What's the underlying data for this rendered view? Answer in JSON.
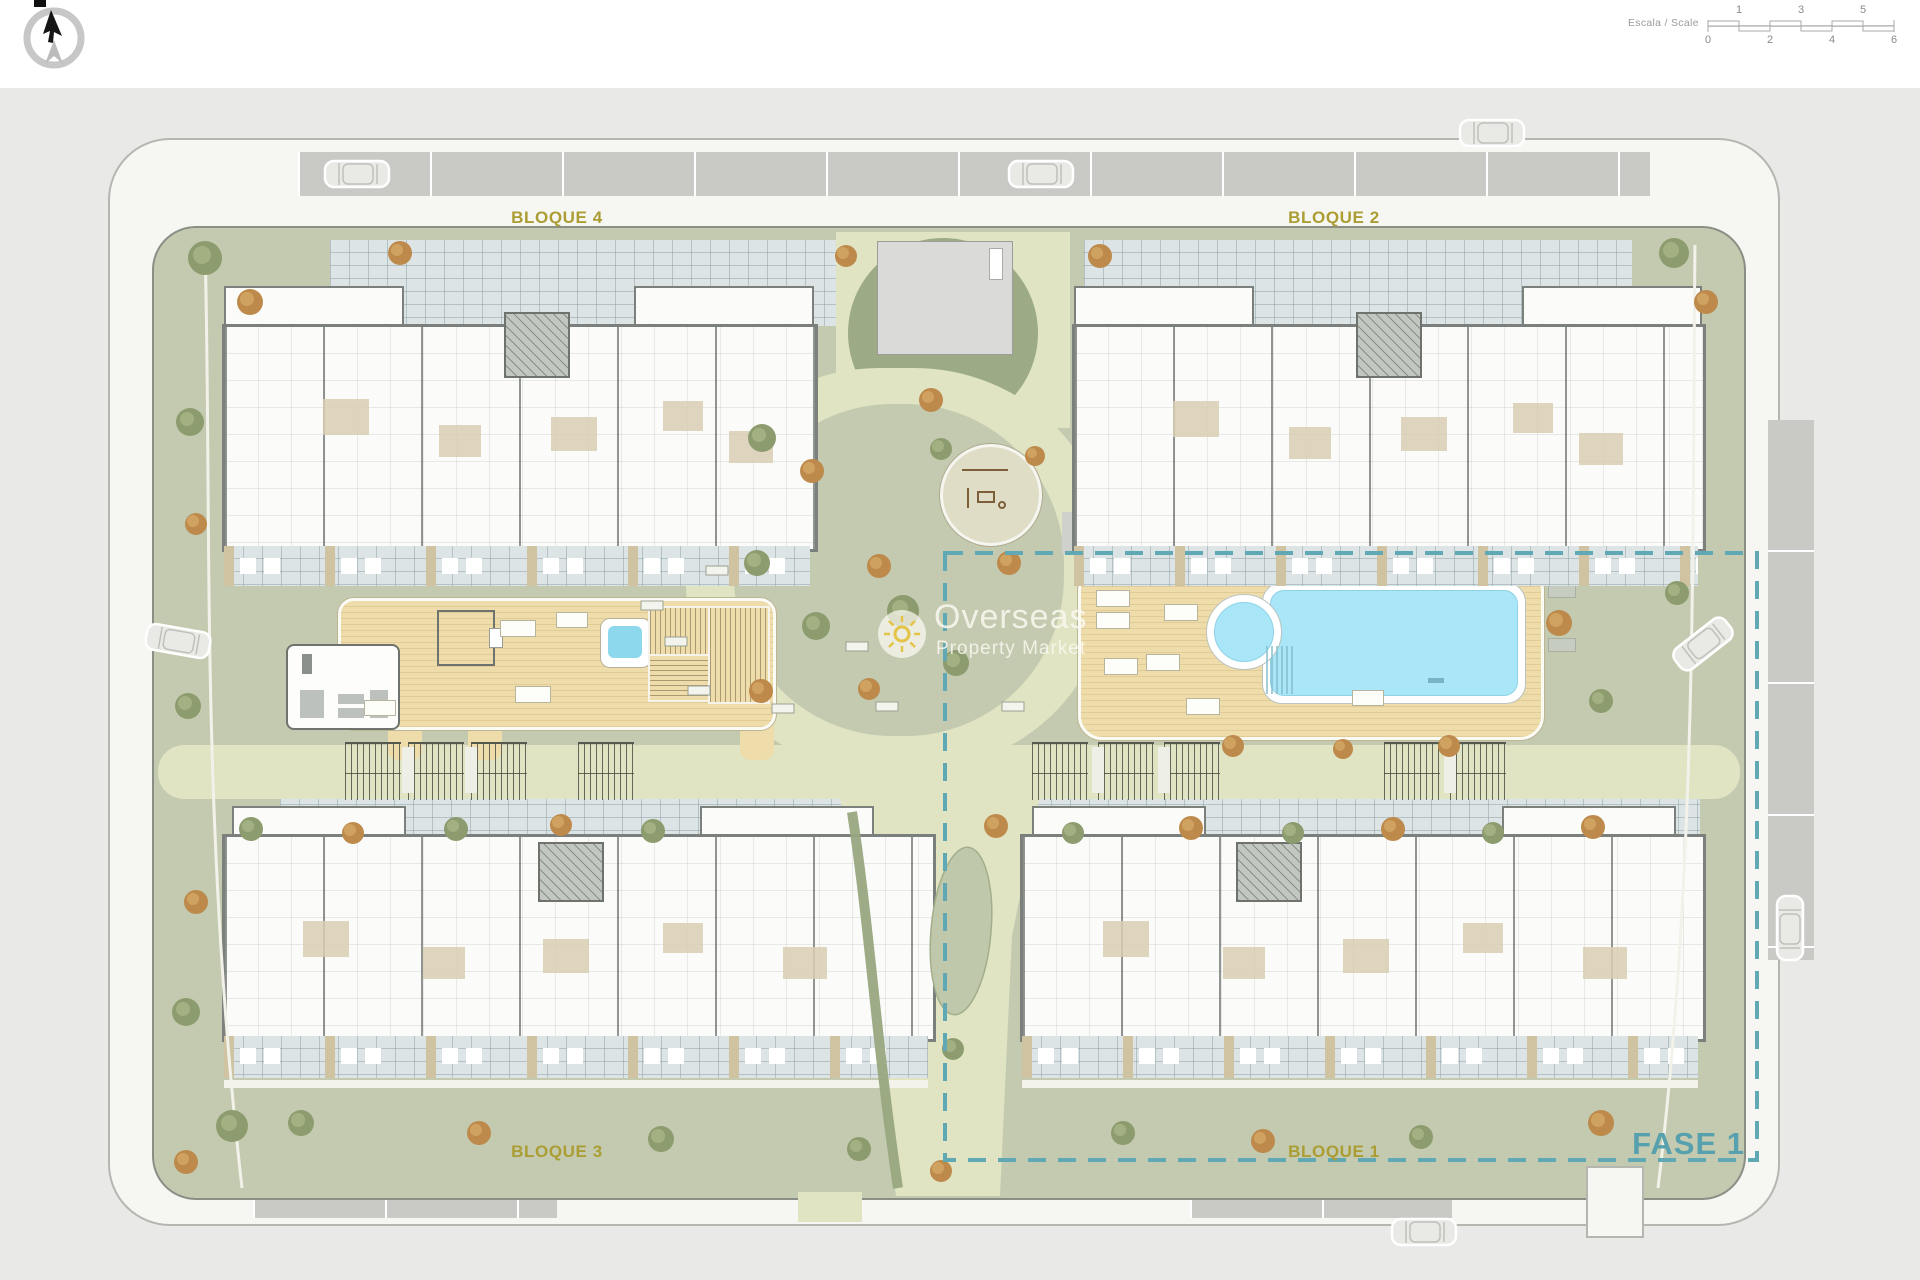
{
  "topbar": {
    "scale": {
      "label": "Escala / Scale",
      "top_ticks": [
        "1",
        "3",
        "5"
      ],
      "bottom_ticks": [
        "0",
        "2",
        "4",
        "6"
      ]
    }
  },
  "plan": {
    "labels": {
      "bloque4": "BLOQUE 4",
      "bloque2": "BLOQUE 2",
      "bloque3": "BLOQUE 3",
      "bloque1": "BLOQUE 1",
      "fase": "FASE 1"
    },
    "watermark": {
      "title": "Overseas",
      "subtitle": "Property Market"
    },
    "colors": {
      "fase_accent": "#57a0ad",
      "block_label": "#ab9d33",
      "pool_water": "#a9e6f7",
      "deck_wood": "#eedcab",
      "lawn_green": "#c3cab0",
      "path_cream": "#e0e4c3",
      "terrace_tile": "#dde4e6",
      "road_gray": "#c9c9c6"
    }
  }
}
